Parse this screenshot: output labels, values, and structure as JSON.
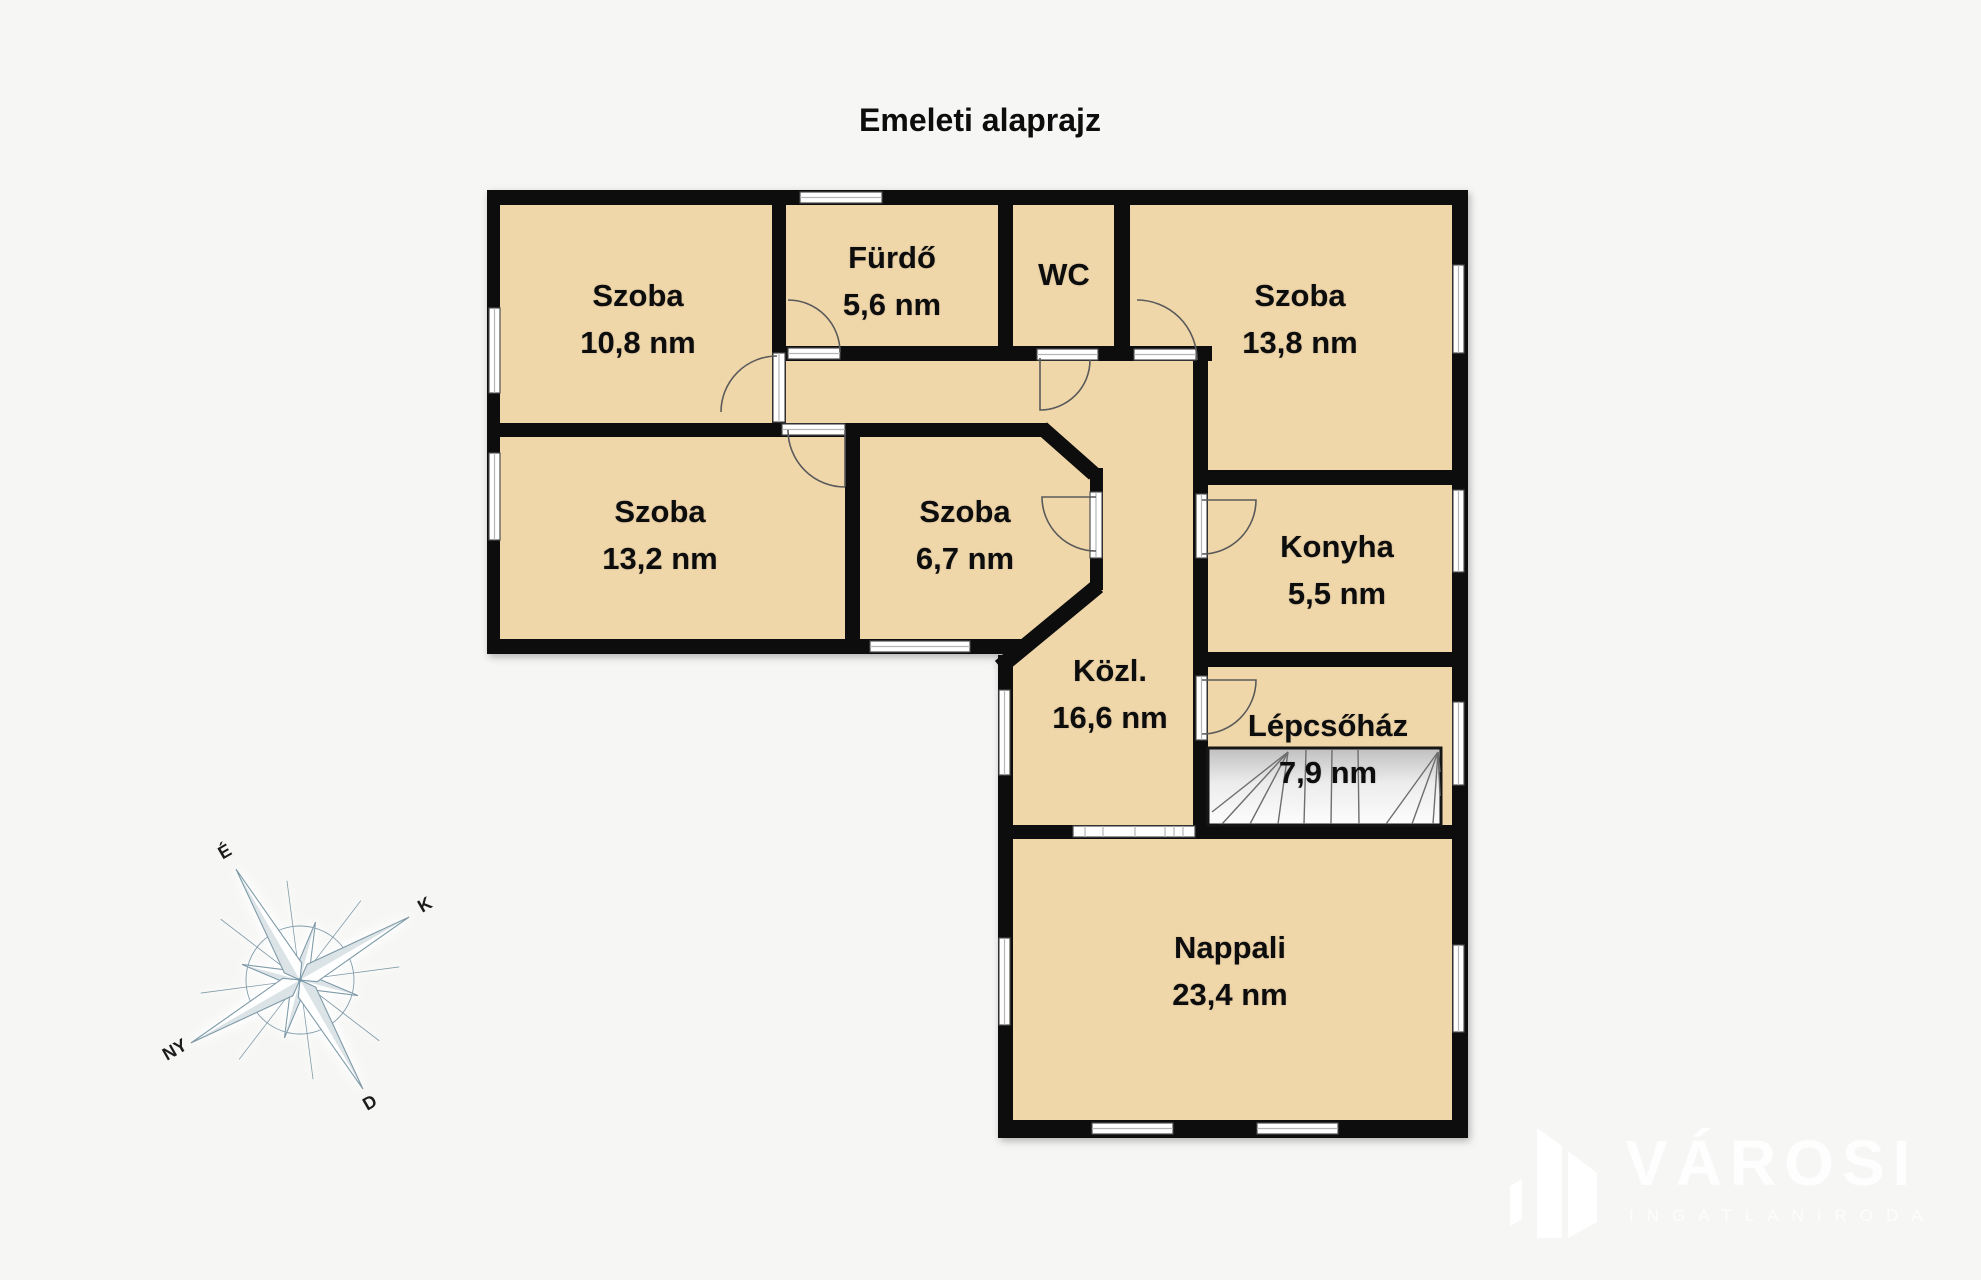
{
  "title": "Emeleti alaprajz",
  "rooms": [
    {
      "name": "Szoba",
      "area": "10,8 nm"
    },
    {
      "name": "Fürdő",
      "area": "5,6 nm"
    },
    {
      "name": "WC",
      "area": ""
    },
    {
      "name": "Szoba",
      "area": "13,8 nm"
    },
    {
      "name": "Szoba",
      "area": "13,2 nm"
    },
    {
      "name": "Szoba",
      "area": "6,7 nm"
    },
    {
      "name": "Konyha",
      "area": "5,5 nm"
    },
    {
      "name": "Közl.",
      "area": "16,6 nm"
    },
    {
      "name": "Lépcsőház",
      "area": "7,9 nm"
    },
    {
      "name": "Nappali",
      "area": "23,4 nm"
    }
  ],
  "compass": {
    "north": "É",
    "east": "K",
    "south": "D",
    "west": "NY"
  },
  "watermark": {
    "brand": "VÁROSI",
    "subtitle": "INGATLANIRODA"
  },
  "colors": {
    "room_fill": "#f0d7aa",
    "wall": "#0b0b0b",
    "background": "#f6f6f5",
    "compass_line": "#7d9aa8",
    "watermark": "#ffffff"
  }
}
